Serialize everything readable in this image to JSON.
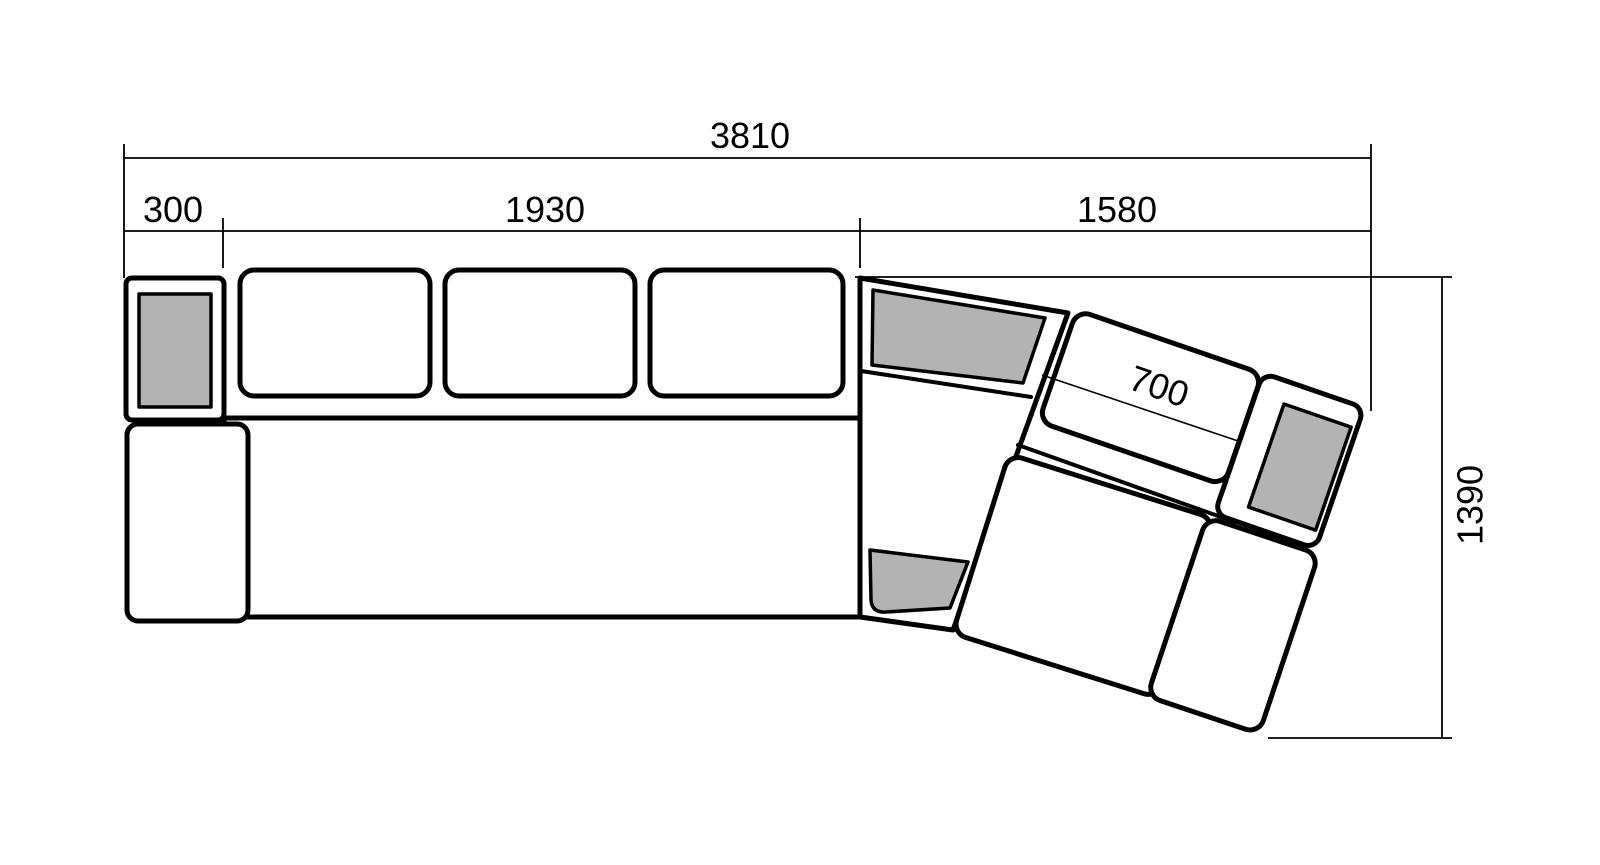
{
  "drawing": {
    "labels": {
      "total_width": "3810",
      "left_arm": "300",
      "straight_section": "1930",
      "corner_section": "1580",
      "corner_seat": "700",
      "depth": "1390"
    },
    "colors": {
      "outline": "#000000",
      "pad_fill": "#b3b3b3",
      "background": "#ffffff"
    }
  }
}
